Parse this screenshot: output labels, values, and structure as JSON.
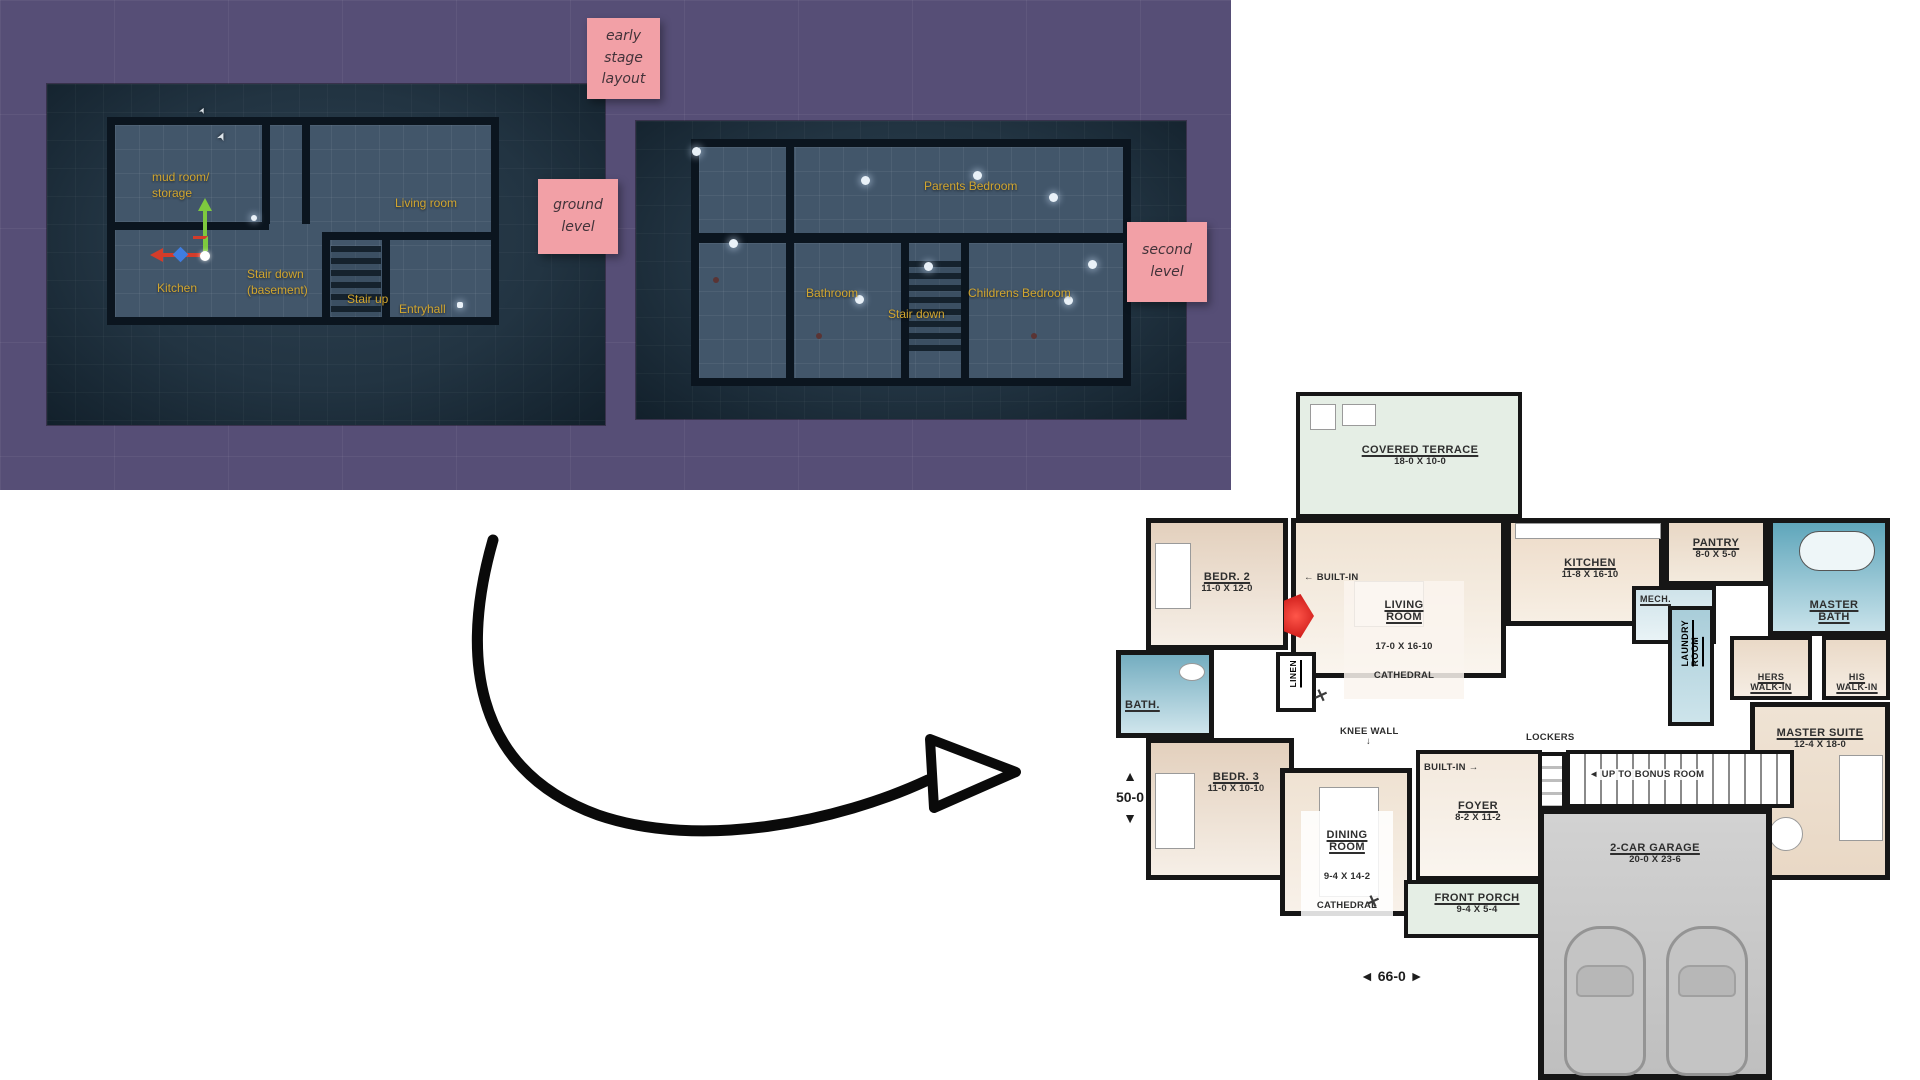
{
  "board": {
    "stickies": {
      "early_stage": "early\nstage\nlayout",
      "ground_level": "ground\nlevel",
      "second_level": "second\nlevel"
    },
    "colors": {
      "board_purple": "#564e76",
      "sticky_pink": "#f2a0a6",
      "viewport_label_yellow": "#d2a62f",
      "viewport_floor_blue": "#42566a",
      "bath_blue": "#79b0c2",
      "room_beige": "#e8d8c6",
      "fireplace_red": "#d61414",
      "arrow_black": "#0a0a0a"
    }
  },
  "icons": {
    "arrow_left": "◄",
    "arrow_right": "►",
    "arrow_up": "▲",
    "arrow_down": "▼",
    "pointer_left": "←",
    "pointer_right": "→",
    "pointer_down": "↓",
    "fan": "✕",
    "cursor": "➤"
  },
  "ground_viewport": {
    "labels": {
      "mud_room": "mud room/\nstorage",
      "living_room": "Living room",
      "kitchen": "Kitchen",
      "stair_down_basement": "Stair down\n(basement)",
      "stair_up": "Stair up",
      "entryhall": "Entryhall"
    }
  },
  "second_viewport": {
    "labels": {
      "parents_bedroom": "Parents Bedroom",
      "bathroom": "Bathroom",
      "stair_down": "Stair down",
      "childrens_bedroom": "Childrens Bedroom"
    }
  },
  "floor_plan": {
    "rooms": {
      "covered_terrace": {
        "name": "COVERED TERRACE",
        "dim": "18-0 X 10-0"
      },
      "kitchen": {
        "name": "KITCHEN",
        "dim": "11-8 X 16-10"
      },
      "pantry": {
        "name": "PANTRY",
        "dim": "8-0 X 5-0"
      },
      "mech": {
        "name": "MECH."
      },
      "master_bath": {
        "name": "MASTER\nBATH"
      },
      "bedroom_2": {
        "name": "BEDR. 2",
        "dim": "11-0 X 12-0"
      },
      "living_room": {
        "name": "LIVING\nROOM",
        "dim": "17-0 X 16-10",
        "note": "CATHEDRAL"
      },
      "laundry_room": {
        "name": "LAUNDRY\nROOM"
      },
      "hers_walk_in": {
        "name": "HERS\nWALK-IN"
      },
      "his_walk_in": {
        "name": "HIS\nWALK-IN"
      },
      "bath": {
        "name": "BATH."
      },
      "linen": {
        "name": "LINEN"
      },
      "bedroom_3": {
        "name": "BEDR. 3",
        "dim": "11-0 X 10-10"
      },
      "master_suite": {
        "name": "MASTER SUITE",
        "dim": "12-4 X 18-0"
      },
      "dining_room": {
        "name": "DINING\nROOM",
        "dim": "9-4 X 14-2",
        "note": "CATHEDRAL"
      },
      "foyer": {
        "name": "FOYER",
        "dim": "8-2 X 11-2"
      },
      "garage": {
        "name": "2-CAR GARAGE",
        "dim": "20-0 X 23-6"
      },
      "front_porch": {
        "name": "FRONT PORCH",
        "dim": "9-4 X 5-4"
      }
    },
    "annotations": {
      "built_in_top": "BUILT-IN",
      "built_in_bottom": "BUILT-IN",
      "knee_wall": "KNEE WALL",
      "lockers": "LOCKERS",
      "up_to_bonus": "UP TO BONUS ROOM",
      "width_dim": "66-0",
      "depth_dim": "50-0"
    }
  }
}
